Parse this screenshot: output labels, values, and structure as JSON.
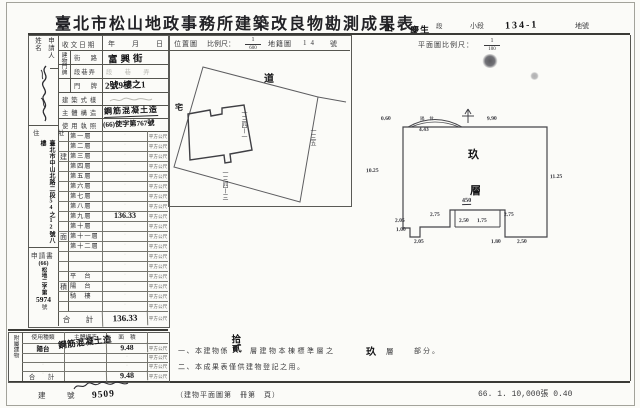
{
  "page": {
    "title": "臺北市松山地政事務所建築改良物勘測成果表",
    "print_info": "66. 1. 10,000張 0.40"
  },
  "header_fields": {
    "district_value": "山",
    "district_label": "區",
    "section_value": "慶生",
    "section_label": "段",
    "subsection_label": "小段",
    "parcel_value": "134-1",
    "parcel_label": "地號"
  },
  "applicant": {
    "name_label": "申請人姓名",
    "address_label": "住　址",
    "address_value": "臺北市中山北路二段54之12號八樓",
    "application_label": "申請書",
    "application_no_head": "(66)",
    "application_no_prefix": "松地二字第",
    "application_no_number": "5974",
    "application_no_suffix": "號"
  },
  "info": {
    "receipt_label": "收文日期",
    "receipt_value": "年　月　日",
    "door_group_label": "建物門牌",
    "door_rows": [
      {
        "label": "街　路",
        "value": "富興街"
      },
      {
        "label": "段巷弄",
        "value": "段　巷　弄"
      },
      {
        "label": "門　牌",
        "value": "2號9樓之1"
      }
    ],
    "style_label": "建築式樣",
    "structure_label": "主體構造",
    "structure_value": "鋼筋混凝土造",
    "license_label": "使用執照",
    "license_value": "(66)使字第767號"
  },
  "floors": {
    "col_chars": [
      "建",
      "面",
      "積"
    ],
    "rows": [
      {
        "label": "第一層",
        "value": ""
      },
      {
        "label": "第二層",
        "value": ""
      },
      {
        "label": "第三層",
        "value": ""
      },
      {
        "label": "第四層",
        "value": ""
      },
      {
        "label": "第五層",
        "value": ""
      },
      {
        "label": "第六層",
        "value": ""
      },
      {
        "label": "第七層",
        "value": ""
      },
      {
        "label": "第八層",
        "value": ""
      },
      {
        "label": "第九層",
        "value": "136.33"
      },
      {
        "label": "第十層",
        "value": ""
      },
      {
        "label": "第十一層",
        "value": ""
      },
      {
        "label": "第十二層",
        "value": ""
      },
      {
        "label": "",
        "value": ""
      },
      {
        "label": "",
        "value": ""
      },
      {
        "label": "平　台",
        "value": ""
      },
      {
        "label": "陽　台",
        "value": ""
      },
      {
        "label": "騎　樓",
        "value": ""
      },
      {
        "label": "",
        "value": ""
      }
    ],
    "total_label": "合　計",
    "total_value": "136.33"
  },
  "units": {
    "sqm": "平方公尺"
  },
  "annex": {
    "side_label": "附屬建物",
    "headers": [
      "使用種類",
      "主體構造",
      "面　積"
    ],
    "structure_hand": "鋼筋混凝土造",
    "rows": [
      {
        "type": "陽台",
        "area": "9.48"
      },
      {
        "type": "",
        "area": ""
      },
      {
        "type": "",
        "area": ""
      }
    ],
    "total_label": "合　計",
    "total_area": "9.48"
  },
  "building_no": {
    "label": "建　號",
    "hand": "9509"
  },
  "notes": {
    "line1_prefix": "一、本建物係",
    "line1_hand_floors": "拾貳",
    "line1_mid": "層建物本棟標準層之",
    "line1_hand_level": "玖",
    "line1_level_label": "層",
    "line1_suffix": "部分。",
    "line2": "二、本成果表僅供建物登記之用。"
  },
  "footer": {
    "plan_ref": "（建物平面圖第　冊第　頁）"
  },
  "site_plan": {
    "box_label": "位置圖",
    "scale_label": "比例尺：",
    "scale_num": "1",
    "scale_den": "600",
    "map_label": "地籍圖",
    "map_no": "14",
    "map_no_suffix": "號",
    "labels": {
      "road": "道",
      "left": "宅",
      "parcel_center": "一三四ー一",
      "parcel_right": "一三五",
      "parcel_bottom": "一三四ー三"
    }
  },
  "floor_plan": {
    "scale_label": "平面圖比例尺：",
    "scale_num": "1",
    "scale_den": "100",
    "balcony_label": "陽　台",
    "room_label_1": "玖",
    "room_label_2": "層",
    "dims": {
      "top_left": "0.60",
      "balcony_w": "4.43",
      "top_right": "9.90",
      "left": "10.25",
      "right": "11.25",
      "shaft_top": "450",
      "shaft_left": "2.75",
      "shaft_in1": "2.50",
      "shaft_in2": "1.75",
      "shaft_right": "2.75",
      "step_left": "2.05",
      "step_down": "1.00",
      "bottom_l": "2.05",
      "bottom_m": "1.80",
      "bottom_r": "2.50"
    }
  }
}
